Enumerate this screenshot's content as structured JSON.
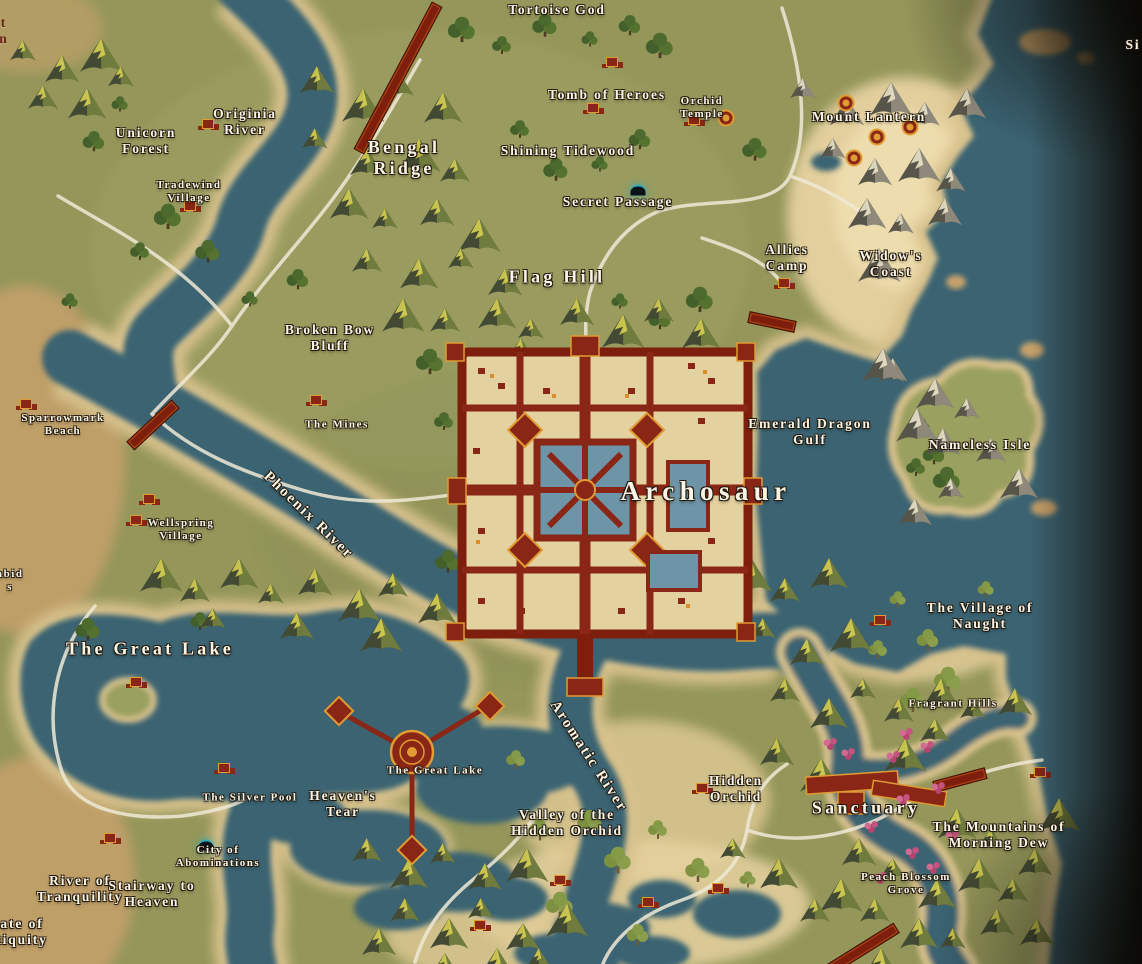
{
  "map": {
    "colors": {
      "water": "#3b6372",
      "land": "#94965a",
      "sand": "#d7c18c",
      "beach_cream": "#ecd9a8",
      "forest": "#4c6a2d",
      "city_red": "#8a2615",
      "city_gold": "#e09b33",
      "road": "#efe9d6",
      "label": "#f8f4e6",
      "cave_glow": "#2ea8b8",
      "blossom_pink": "#c5527f"
    },
    "labels": [
      {
        "text": "Tortoise God",
        "x": 557,
        "y": 10,
        "size": "md"
      },
      {
        "text": "Originia\nRiver",
        "x": 245,
        "y": 122,
        "size": "md"
      },
      {
        "text": "Unicorn\nForest",
        "x": 146,
        "y": 141,
        "size": "md"
      },
      {
        "text": "Tradewind\nVillage",
        "x": 189,
        "y": 192,
        "size": "sm"
      },
      {
        "text": "Bengal\nRidge",
        "x": 404,
        "y": 158,
        "size": "lg"
      },
      {
        "text": "Tomb of Heroes",
        "x": 607,
        "y": 95,
        "size": "md"
      },
      {
        "text": "Orchid\nTemple",
        "x": 702,
        "y": 108,
        "size": "sm"
      },
      {
        "text": "Shining Tidewood",
        "x": 568,
        "y": 151,
        "size": "md"
      },
      {
        "text": "Mount Lantern",
        "x": 869,
        "y": 117,
        "size": "md"
      },
      {
        "text": "Secret Passage",
        "x": 618,
        "y": 202,
        "size": "md"
      },
      {
        "text": "Allies\nCamp",
        "x": 787,
        "y": 258,
        "size": "md"
      },
      {
        "text": "Widow's\nCoast",
        "x": 891,
        "y": 264,
        "size": "md"
      },
      {
        "text": "Flag Hill",
        "x": 557,
        "y": 277,
        "size": "lg"
      },
      {
        "text": "Broken Bow\nBluff",
        "x": 330,
        "y": 338,
        "size": "md"
      },
      {
        "text": "Sparrowmark\nBeach",
        "x": 63,
        "y": 425,
        "size": "sm"
      },
      {
        "text": "The Mines",
        "x": 337,
        "y": 425,
        "size": "sm"
      },
      {
        "text": "Emerald Dragon\nGulf",
        "x": 810,
        "y": 432,
        "size": "md"
      },
      {
        "text": "Nameless Isle",
        "x": 980,
        "y": 445,
        "size": "md"
      },
      {
        "text": "Phoenix River",
        "x": 308,
        "y": 516,
        "size": "riv",
        "rot": 44
      },
      {
        "text": "Wellspring\nVillage",
        "x": 181,
        "y": 530,
        "size": "sm"
      },
      {
        "text": "Archosaur",
        "x": 706,
        "y": 492,
        "size": "xl"
      },
      {
        "text": "The Great Lake",
        "x": 150,
        "y": 649,
        "size": "lg"
      },
      {
        "text": "The Village of\nNaught",
        "x": 980,
        "y": 616,
        "size": "md"
      },
      {
        "text": "Fragrant Hills",
        "x": 953,
        "y": 704,
        "size": "sm"
      },
      {
        "text": "Hidden\nOrchid",
        "x": 736,
        "y": 789,
        "size": "md"
      },
      {
        "text": "Sanctuary",
        "x": 866,
        "y": 808,
        "size": "lg"
      },
      {
        "text": "The Great Lake",
        "x": 435,
        "y": 771,
        "size": "sm"
      },
      {
        "text": "The Silver Pool",
        "x": 250,
        "y": 798,
        "size": "sm"
      },
      {
        "text": "Heaven's\nTear",
        "x": 343,
        "y": 804,
        "size": "md"
      },
      {
        "text": "Aromatic River",
        "x": 588,
        "y": 757,
        "size": "riv",
        "rot": 57
      },
      {
        "text": "Valley of the\nHidden Orchid",
        "x": 567,
        "y": 823,
        "size": "md"
      },
      {
        "text": "The Mountains of\nMorning Dew",
        "x": 999,
        "y": 835,
        "size": "md"
      },
      {
        "text": "Peach Blossom\nGrove",
        "x": 906,
        "y": 884,
        "size": "sm"
      },
      {
        "text": "City of\nAbominations",
        "x": 218,
        "y": 857,
        "size": "sm"
      },
      {
        "text": "River of\nTranquility",
        "x": 80,
        "y": 889,
        "size": "md"
      },
      {
        "text": "Stairway to\nHeaven",
        "x": 152,
        "y": 894,
        "size": "md"
      },
      {
        "text": "t\nn",
        "x": 4,
        "y": 31,
        "size": "md",
        "color": "red"
      },
      {
        "text": "Si",
        "x": 1133,
        "y": 45,
        "size": "md"
      },
      {
        "text": "abid\ns",
        "x": 10,
        "y": 581,
        "size": "sm"
      },
      {
        "text": "ate of\ntiquity",
        "x": 22,
        "y": 932,
        "size": "md"
      }
    ],
    "icons": [
      {
        "name": "secret-passage-cave-icon",
        "type": "cave",
        "x": 638,
        "y": 190
      },
      {
        "name": "abominations-cave-icon",
        "type": "cave",
        "x": 206,
        "y": 845
      },
      {
        "name": "originia-bridge-icon",
        "type": "bridge",
        "x": 398,
        "y": 78,
        "w": 165,
        "rot": 118
      },
      {
        "name": "phoenix-bridge-icon",
        "type": "bridge",
        "x": 153,
        "y": 425,
        "w": 60,
        "rot": -43
      },
      {
        "name": "coast-pier-icon",
        "type": "bridge",
        "x": 772,
        "y": 322,
        "w": 46,
        "rot": 12
      },
      {
        "name": "sanctuary-bridge-icon",
        "type": "bridge",
        "x": 960,
        "y": 780,
        "w": 52,
        "rot": -15
      },
      {
        "name": "grove-bridge-icon",
        "type": "bridge",
        "x": 861,
        "y": 950,
        "w": 82,
        "rot": -32
      },
      {
        "name": "lantern-tower-icon",
        "type": "tower",
        "x": 846,
        "y": 103
      },
      {
        "name": "lantern-tower-icon",
        "type": "tower",
        "x": 910,
        "y": 127
      },
      {
        "name": "lantern-tower-icon",
        "type": "tower",
        "x": 877,
        "y": 137
      },
      {
        "name": "lantern-tower-icon",
        "type": "tower",
        "x": 854,
        "y": 158
      },
      {
        "name": "orchid-round-temple-icon",
        "type": "tower",
        "x": 726,
        "y": 118
      },
      {
        "name": "tradewind-village-icon",
        "type": "settlement",
        "x": 190,
        "y": 206
      },
      {
        "name": "tomb-of-heroes-icon",
        "type": "settlement",
        "x": 612,
        "y": 62
      },
      {
        "name": "tomb-shrine-icon",
        "type": "settlement",
        "x": 593,
        "y": 108
      },
      {
        "name": "orchid-temple-buildings-icon",
        "type": "settlement",
        "x": 694,
        "y": 120
      },
      {
        "name": "allies-camp-icon",
        "type": "settlement",
        "x": 784,
        "y": 283
      },
      {
        "name": "unicorn-ruins-icon",
        "type": "settlement",
        "x": 208,
        "y": 124
      },
      {
        "name": "mines-camp-icon",
        "type": "settlement",
        "x": 316,
        "y": 400
      },
      {
        "name": "wellspring-village-icon",
        "type": "settlement",
        "x": 149,
        "y": 499
      },
      {
        "name": "wellspring-village-icon",
        "type": "settlement",
        "x": 136,
        "y": 520
      },
      {
        "name": "sparrowmark-camp-icon",
        "type": "settlement",
        "x": 26,
        "y": 404
      },
      {
        "name": "naught-dock-icon",
        "type": "settlement",
        "x": 880,
        "y": 620
      },
      {
        "name": "silver-pool-camp-icon",
        "type": "settlement",
        "x": 224,
        "y": 768
      },
      {
        "name": "lake-isle-hut-icon",
        "type": "settlement",
        "x": 136,
        "y": 682
      },
      {
        "name": "hidden-orchid-camp-icon",
        "type": "settlement",
        "x": 702,
        "y": 788
      },
      {
        "name": "morning-dew-camp-icon",
        "type": "settlement",
        "x": 1040,
        "y": 772
      },
      {
        "name": "beach-camp-icon",
        "type": "settlement",
        "x": 560,
        "y": 880
      },
      {
        "name": "beach-camp-icon",
        "type": "settlement",
        "x": 648,
        "y": 902
      },
      {
        "name": "beach-camp-icon",
        "type": "settlement",
        "x": 718,
        "y": 888
      },
      {
        "name": "stairway-camp-icon",
        "type": "settlement",
        "x": 110,
        "y": 838
      },
      {
        "name": "valley-camp-icon",
        "type": "settlement",
        "x": 480,
        "y": 925
      },
      {
        "name": "blossom-tree-icon",
        "type": "blossom",
        "x": 906,
        "y": 734
      },
      {
        "name": "blossom-tree-icon",
        "type": "blossom",
        "x": 927,
        "y": 747
      },
      {
        "name": "blossom-tree-icon",
        "type": "blossom",
        "x": 893,
        "y": 757
      },
      {
        "name": "blossom-tree-icon",
        "type": "blossom",
        "x": 938,
        "y": 788
      },
      {
        "name": "blossom-tree-icon",
        "type": "blossom",
        "x": 903,
        "y": 800
      },
      {
        "name": "blossom-tree-icon",
        "type": "blossom",
        "x": 871,
        "y": 827
      },
      {
        "name": "blossom-tree-icon",
        "type": "blossom",
        "x": 912,
        "y": 853
      },
      {
        "name": "blossom-tree-icon",
        "type": "blossom",
        "x": 933,
        "y": 868
      },
      {
        "name": "blossom-tree-icon",
        "type": "blossom",
        "x": 952,
        "y": 836
      },
      {
        "name": "blossom-tree-icon",
        "type": "blossom",
        "x": 880,
        "y": 878
      },
      {
        "name": "blossom-tree-icon",
        "type": "blossom",
        "x": 830,
        "y": 744
      },
      {
        "name": "blossom-tree-icon",
        "type": "blossom",
        "x": 848,
        "y": 754
      }
    ]
  }
}
